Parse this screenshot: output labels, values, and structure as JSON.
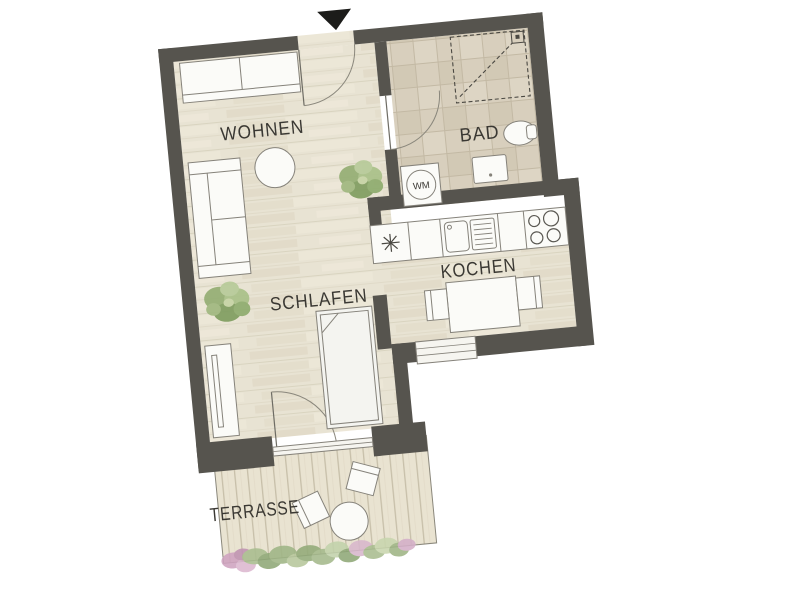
{
  "floor_plan": {
    "rooms": [
      {
        "id": "wohnen",
        "label": "WOHNEN"
      },
      {
        "id": "bad",
        "label": "BAD"
      },
      {
        "id": "kochen",
        "label": "KOCHEN"
      },
      {
        "id": "schlafen",
        "label": "SCHLAFEN"
      },
      {
        "id": "terrasse",
        "label": "TERRASSE"
      }
    ],
    "appliances": {
      "washing_machine_label": "WM"
    },
    "colors": {
      "wall": "#56544e",
      "wood_floor": "#e8e3d3",
      "tile_floor": "#d8cfbd",
      "deck": "#e9e3d1",
      "furniture_fill": "#fbfbf8",
      "furniture_outline": "#85827a",
      "label_text": "#3a3833",
      "plant_green": "#8fae6d",
      "flower_pink": "#d4a8c4",
      "entrance_marker": "#1c1c1a"
    }
  }
}
